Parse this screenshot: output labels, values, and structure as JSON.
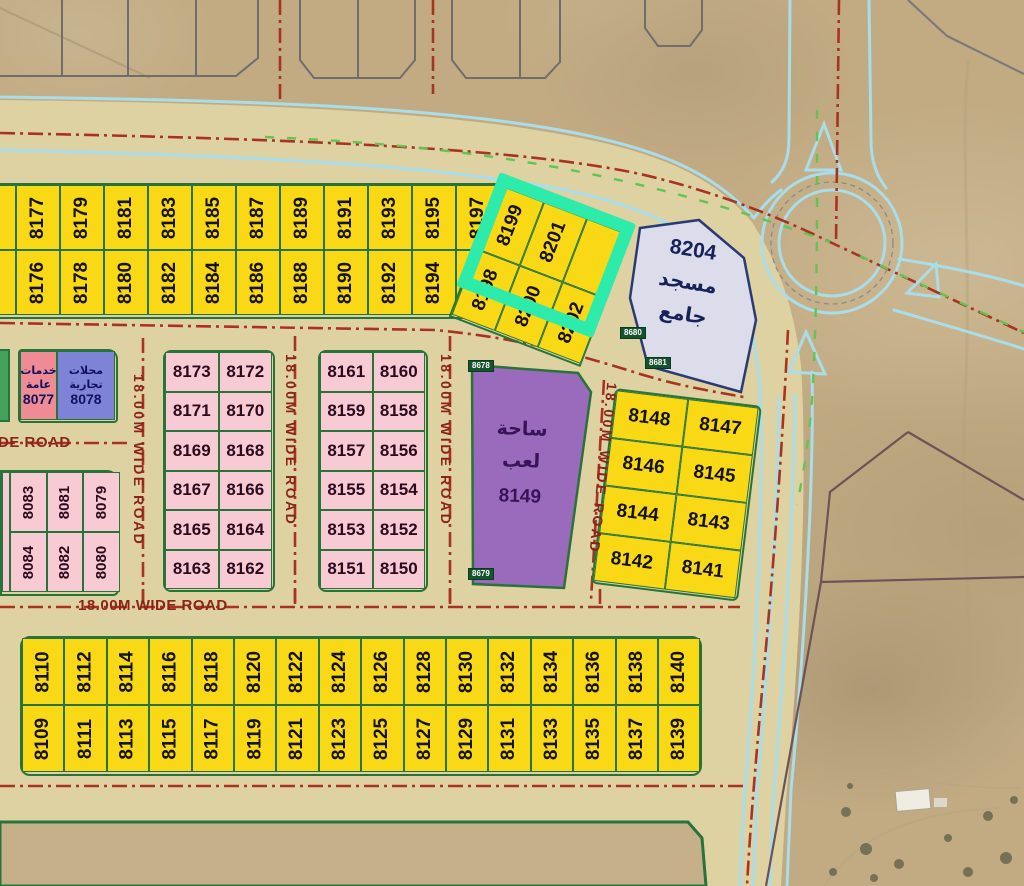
{
  "colors": {
    "bg": "#c2ab83",
    "beige": "#ded2a3",
    "yellow": "#f9d916",
    "pink": "#f8cbd4",
    "purple": "#9a6abc",
    "mosque_fill": "#dcdcea",
    "salmon": "#ef8b95",
    "blue": "#7e83d7",
    "green_border": "#27743a",
    "red_line": "#a93322",
    "label_red": "#8a241a",
    "cyan": "#a8dde9",
    "green_dash": "#63c453",
    "highlight": "#2debaa",
    "tag_bg": "#14532d",
    "gray_line": "#7a7a76",
    "boundary": "#6d5258"
  },
  "roads": {
    "wide_road": "18.00M WIDE ROAD",
    "partial_label": "DE ROAD"
  },
  "mosque": {
    "number": "8204",
    "name_line1": "مسجد",
    "name_line2": "جامع"
  },
  "playground": {
    "number": "8149",
    "name_line1": "ساحة",
    "name_line2": "لعب"
  },
  "services_plot": {
    "number": "8077",
    "name_line1": "خدمات",
    "name_line2": "عامة"
  },
  "commercial_plot": {
    "number": "8078",
    "name_line1": "محلات",
    "name_line2": "تجارية"
  },
  "survey_tags": [
    "8678",
    "8679",
    "8680",
    "8681"
  ],
  "highlighted_plots": [
    "8199",
    "8201"
  ],
  "blocks": {
    "top_row": {
      "columns": [
        {
          "top": "8175",
          "bottom": "8174"
        },
        {
          "top": "8177",
          "bottom": "8176"
        },
        {
          "top": "8179",
          "bottom": "8178"
        },
        {
          "top": "8181",
          "bottom": "8180"
        },
        {
          "top": "8183",
          "bottom": "8182"
        },
        {
          "top": "8185",
          "bottom": "8184"
        },
        {
          "top": "8187",
          "bottom": "8186"
        },
        {
          "top": "8189",
          "bottom": "8188"
        },
        {
          "top": "8191",
          "bottom": "8190"
        },
        {
          "top": "8193",
          "bottom": "8192"
        },
        {
          "top": "8195",
          "bottom": "8194"
        },
        {
          "top": "8197",
          "bottom": "8196"
        }
      ]
    },
    "top_row_tilted": {
      "columns": [
        {
          "top": "8199",
          "bottom": "8198"
        },
        {
          "top": "8201",
          "bottom": "8200"
        },
        {
          "top": "",
          "bottom": "8202"
        }
      ]
    },
    "pink_west": {
      "rows": [
        [
          "8173",
          "8172"
        ],
        [
          "8171",
          "8170"
        ],
        [
          "8169",
          "8168"
        ],
        [
          "8167",
          "8166"
        ],
        [
          "8165",
          "8164"
        ],
        [
          "8163",
          "8162"
        ]
      ]
    },
    "pink_east": {
      "rows": [
        [
          "8161",
          "8160"
        ],
        [
          "8159",
          "8158"
        ],
        [
          "8157",
          "8156"
        ],
        [
          "8155",
          "8154"
        ],
        [
          "8153",
          "8152"
        ],
        [
          "8151",
          "8150"
        ]
      ]
    },
    "yellow_east": {
      "rows": [
        [
          "8148",
          "8147"
        ],
        [
          "8146",
          "8145"
        ],
        [
          "8144",
          "8143"
        ],
        [
          "8142",
          "8141"
        ]
      ]
    },
    "pink_southwest": {
      "columns": [
        {
          "top": "8083",
          "bottom": "8084"
        },
        {
          "top": "8081",
          "bottom": "8082"
        },
        {
          "top": "8079",
          "bottom": "8080"
        }
      ]
    },
    "bottom_row": {
      "columns": [
        {
          "top": "8110",
          "bottom": "8109"
        },
        {
          "top": "8112",
          "bottom": "8111"
        },
        {
          "top": "8114",
          "bottom": "8113"
        },
        {
          "top": "8116",
          "bottom": "8115"
        },
        {
          "top": "8118",
          "bottom": "8117"
        },
        {
          "top": "8120",
          "bottom": "8119"
        },
        {
          "top": "8122",
          "bottom": "8121"
        },
        {
          "top": "8124",
          "bottom": "8123"
        },
        {
          "top": "8126",
          "bottom": "8125"
        },
        {
          "top": "8128",
          "bottom": "8127"
        },
        {
          "top": "8130",
          "bottom": "8129"
        },
        {
          "top": "8132",
          "bottom": "8131"
        },
        {
          "top": "8134",
          "bottom": "8133"
        },
        {
          "top": "8136",
          "bottom": "8135"
        },
        {
          "top": "8138",
          "bottom": "8137"
        },
        {
          "top": "8140",
          "bottom": "8139"
        }
      ]
    }
  }
}
